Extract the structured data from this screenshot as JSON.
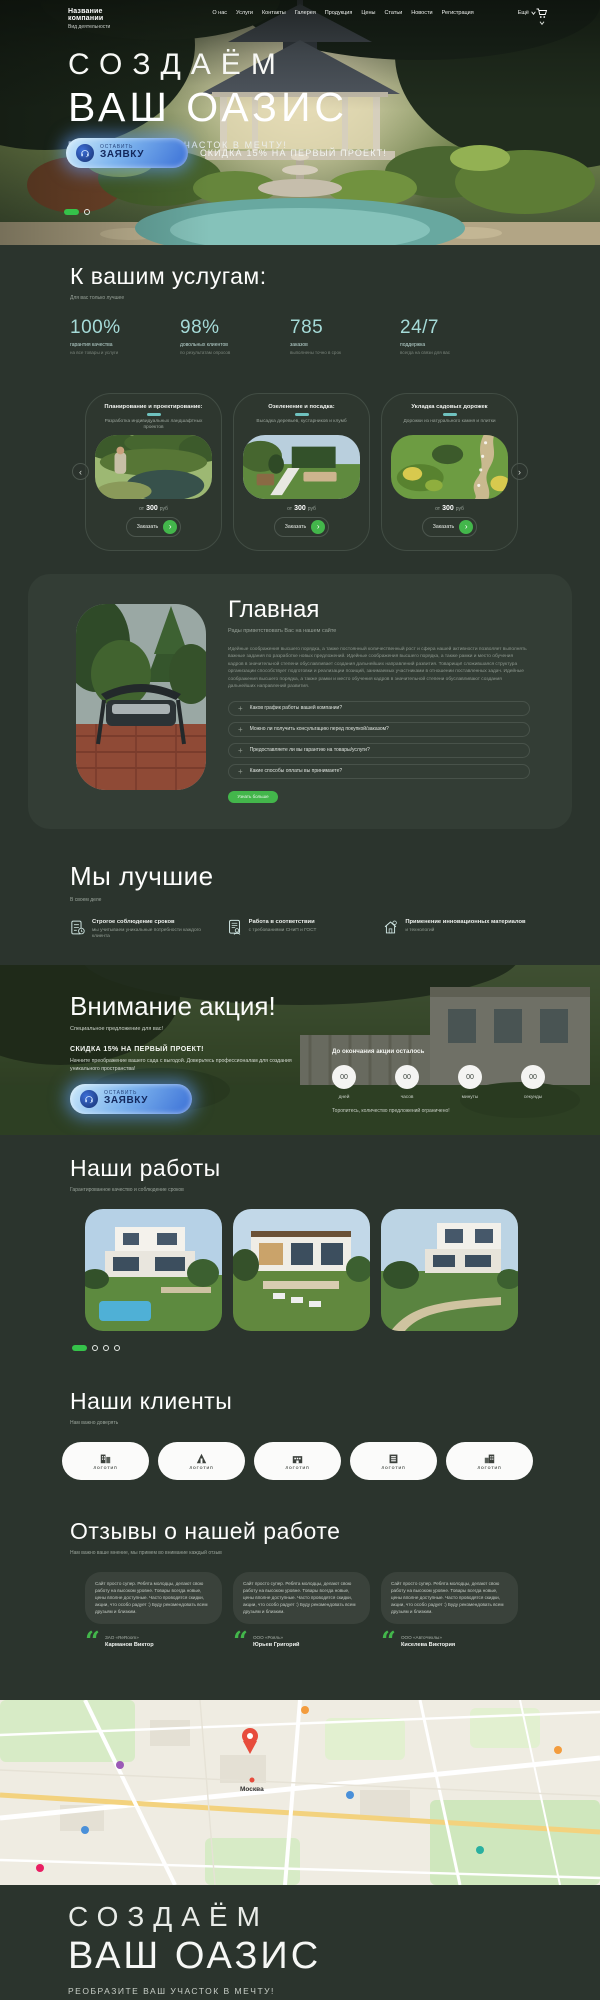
{
  "theme": {
    "bg": "#2b342d",
    "panel": "#333d35",
    "accent_green": "#43b64b",
    "accent_teal": "#8ed1cf",
    "accent_blue": "#3a6fd6"
  },
  "header": {
    "company_name": "Название компании",
    "company_subtitle": "Вид деятельности",
    "nav": [
      "О нас",
      "Услуги",
      "Контакты",
      "Галерея",
      "Продукция",
      "Цены",
      "Статьи",
      "Новости",
      "Регистрация"
    ],
    "more_label": "Ещё"
  },
  "hero": {
    "title_line1": "СОЗДАЁМ",
    "title_line2": "ВАШ ОАЗИС",
    "tagline": "РЕОБРАЗИТЕ ВАШ УЧАСТОК В МЕЧТУ!",
    "cta_small": "ОСТАВИТЬ",
    "cta_big": "ЗАЯВКУ",
    "promo": "СКИДКА 15% НА ПЕРВЫЙ ПРОЕКТ!"
  },
  "services": {
    "title": "К вашим услугам:",
    "subtitle": "Для вас только лучшее",
    "stats": [
      {
        "value": "100%",
        "label": "гарантия качества",
        "sub": "на все товары и услуги"
      },
      {
        "value": "98%",
        "label": "довольных клиентов",
        "sub": "по результатам опросов"
      },
      {
        "value": "785",
        "label": "заказов",
        "sub": "выполнены точно в срок"
      },
      {
        "value": "24/7",
        "label": "поддержка",
        "sub": "всегда на связи для вас"
      }
    ],
    "cards": [
      {
        "title": "Планирование и проектирование:",
        "desc": "Разработка индивидуальных ландшафтных проектов",
        "price_prefix": "от",
        "price": "300",
        "price_suffix": "руб",
        "button": "Заказать"
      },
      {
        "title": "Озеленение и посадка:",
        "desc": "Высадка деревьев, кустарников и клумб",
        "price_prefix": "от",
        "price": "300",
        "price_suffix": "руб",
        "button": "Заказать"
      },
      {
        "title": "Укладка садовых дорожек",
        "desc": "Дорожки из натурального камня и плитки",
        "price_prefix": "от",
        "price": "300",
        "price_suffix": "руб",
        "button": "Заказать"
      }
    ]
  },
  "main_section": {
    "title": "Главная",
    "subtitle": "Рады приветствовать Вас на нашем сайте",
    "paragraph": "Идейные соображения высшего порядка, а также постоянный количественный рост и сфера нашей активности позволяет выполнять важные задания по разработке новых предложений. Идейные соображения высшего порядка, а также рамки и место обучения кадров в значительной степени обуславливает создания дальнейших направлений развития. Товарищи! сложившаяся структура организации способствует подготовки и реализации позиций, занимаемых участниками в отношении поставленных задач. Идейные соображения высшего порядка, а также рамки и место обучения кадров в значительной степени обуславливают создания дальнейших направлений развития.",
    "faq": [
      "Каков график работы вашей компании?",
      "Можно ли получить консультацию перед покупкой/заказом?",
      "Предоставляете ли вы гарантию на товары/услуги?",
      "Какие способы оплаты вы принимаете?"
    ],
    "button": "Узнать больше"
  },
  "best": {
    "title": "Мы лучшие",
    "subtitle": "В своем деле",
    "features": [
      {
        "title": "Строгое соблюдение сроков",
        "desc": "мы учитываем уникальные потребности каждого клиента"
      },
      {
        "title": "Работа в соответствии",
        "desc": "с требованиями СНиП и ГОСТ"
      },
      {
        "title": "Применение инновационных материалов",
        "desc": "и технологий"
      }
    ]
  },
  "promo": {
    "title": "Внимание акция!",
    "subtitle": "Специальное предложение для вас!",
    "offer": "СКИДКА 15% НА ПЕРВЫЙ ПРОЕКТ!",
    "desc": "Начните преображение вашего сада с выгодой. Доверьтесь профессионалам для создания уникального пространства!",
    "cta_small": "ОСТАВИТЬ",
    "cta_big": "ЗАЯВКУ",
    "countdown_title": "До окончания акции осталось",
    "countdown": [
      {
        "value": "00",
        "label": "дней"
      },
      {
        "value": "00",
        "label": "часов"
      },
      {
        "value": "00",
        "label": "минуты"
      },
      {
        "value": "00",
        "label": "секунды"
      }
    ],
    "note": "Торопитесь, количество предложений ограничено!"
  },
  "works": {
    "title": "Наши работы",
    "subtitle": "Гарантированное качество и соблюдение сроков"
  },
  "clients": {
    "title": "Наши клиенты",
    "subtitle": "Нам важно доверять",
    "logo_label": "ЛОГОТИП"
  },
  "reviews": {
    "title": "Отзывы о нашей работе",
    "subtitle": "Нам важно ваше мнение, мы примем во внимание каждый отзыв",
    "items": [
      {
        "text": "Сайт просто супер. Ребята молодцы, делают свою работу на высоком уровне. Товары всегда новые, цены вполне доступные. Часто проводятся скидки, акции, что особо радует :) Буду рекомендовать всем друзьям и близким.",
        "company": "ЗАО «ReRoom»",
        "name": "Карманов Виктор"
      },
      {
        "text": "Сайт просто супер. Ребята молодцы, делают свою работу на высоком уровне. Товары всегда новые, цены вполне доступные. Часто проводятся скидки, акции, что особо радует :) Буду рекомендовать всем друзьям и близким.",
        "company": "ООО «Рояль»",
        "name": "Юрьев Григорий"
      },
      {
        "text": "Сайт просто супер. Ребята молодцы, делают свою работу на высоком уровне. Товары всегда новые, цены вполне доступные. Часто проводятся скидки, акции, что особо радует :) Буду рекомендовать всем друзьям и близким.",
        "company": "ООО «АвтоЧехлы»",
        "name": "Киселева Виктория"
      }
    ]
  },
  "map": {
    "city": "Москва"
  },
  "footer": {
    "title_line1": "СОЗДАЁМ",
    "title_line2": "ВАШ ОАЗИС",
    "tagline": "РЕОБРАЗИТЕ ВАШ УЧАСТОК В МЕЧТУ!"
  }
}
